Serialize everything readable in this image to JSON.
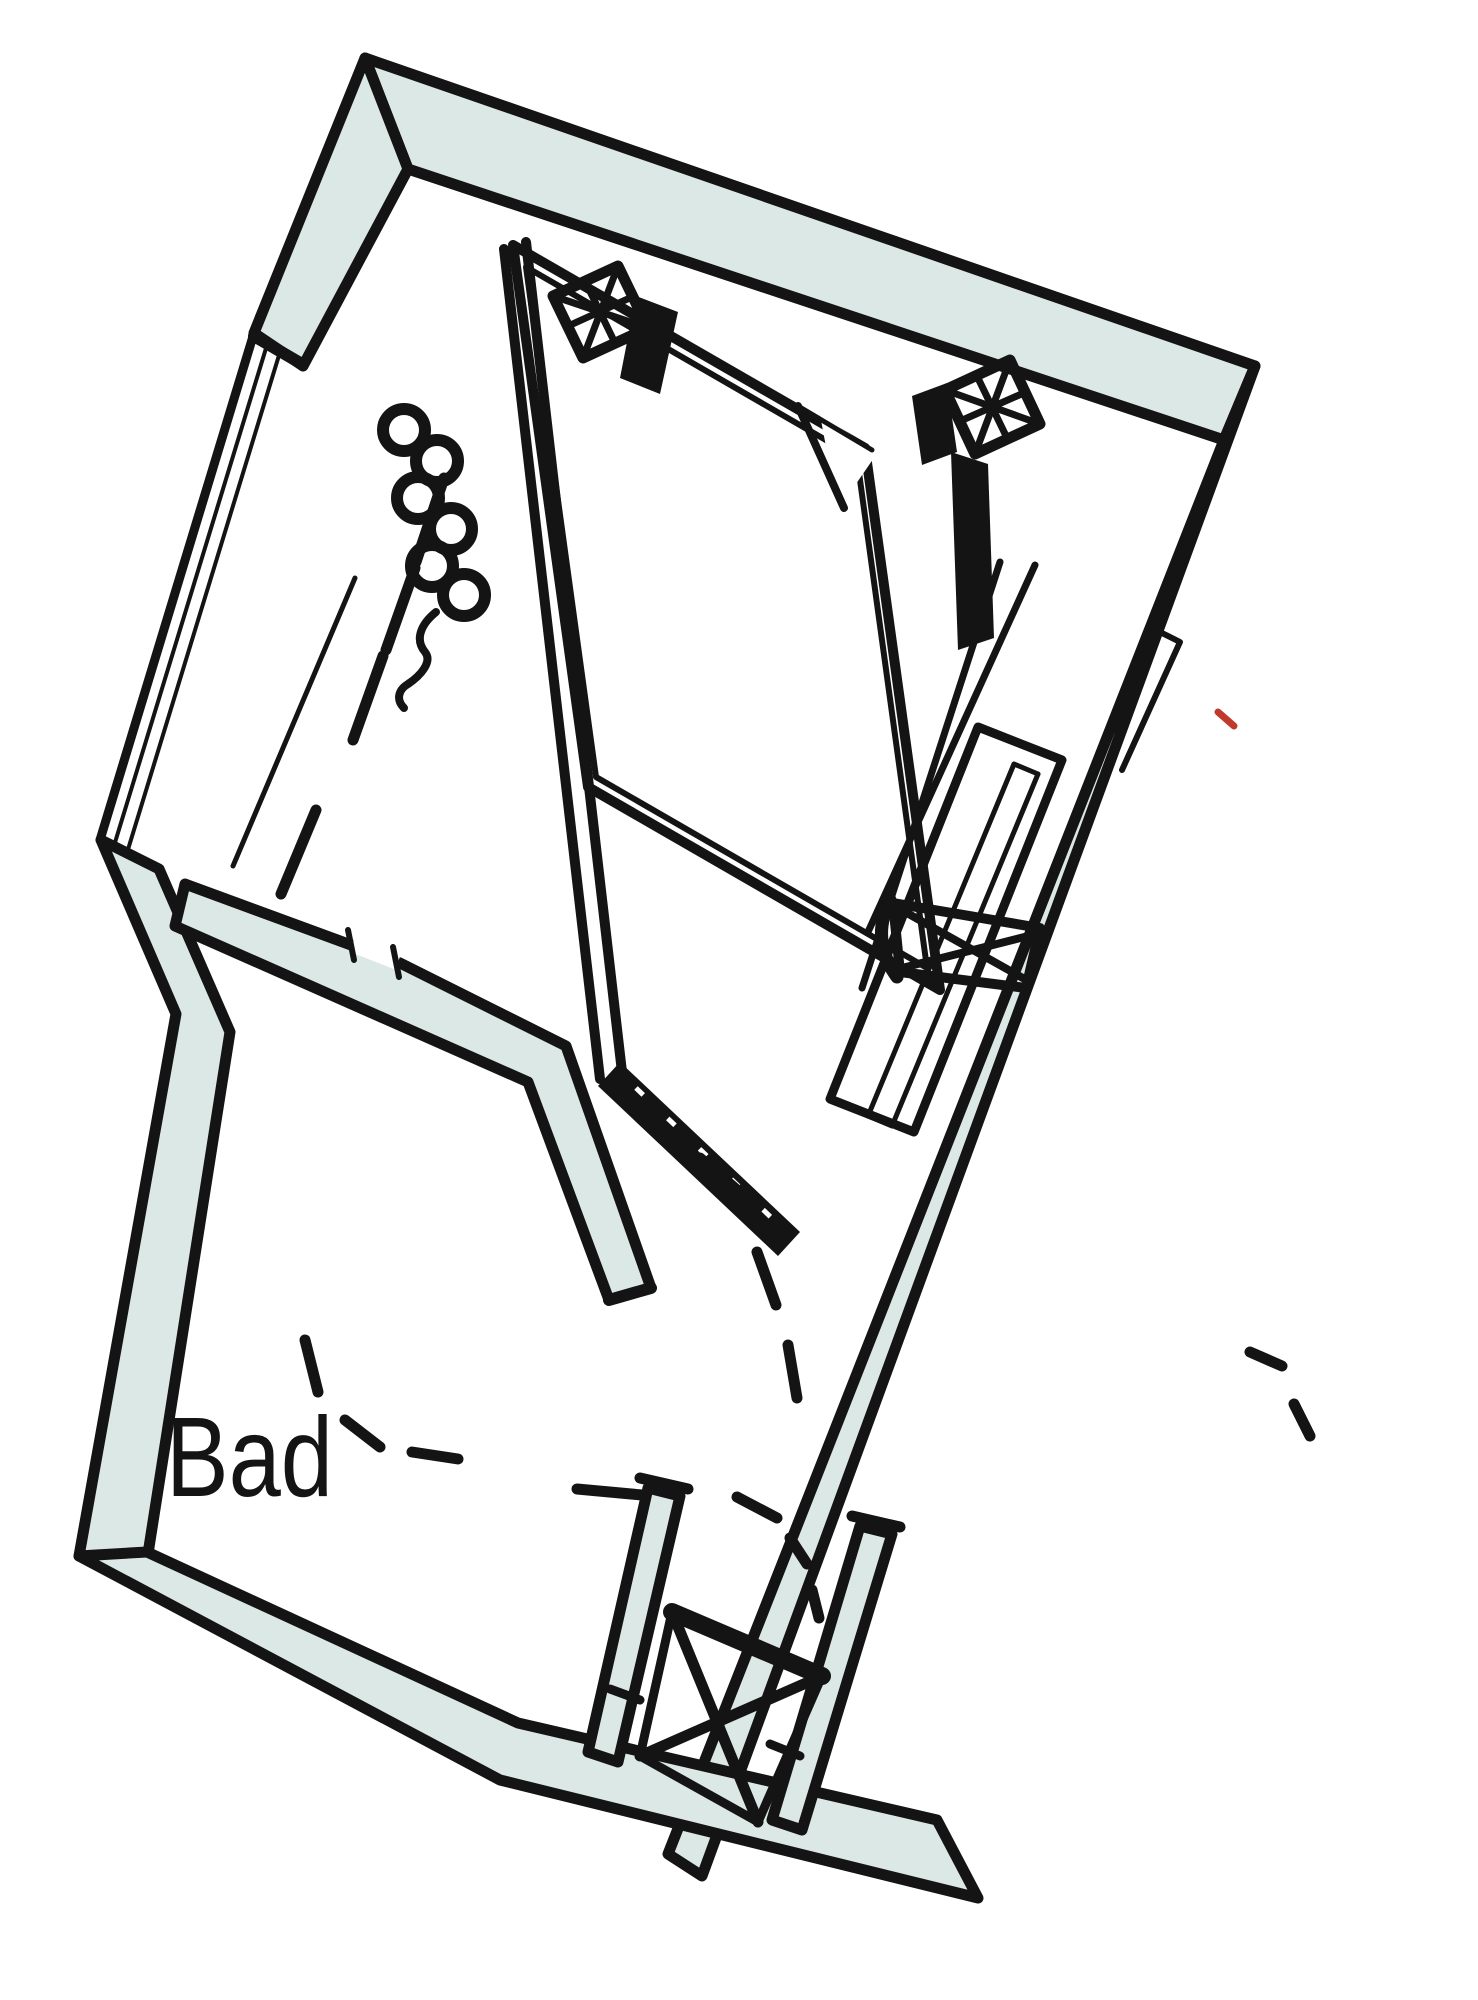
{
  "document": {
    "type": "architectural-floor-plan",
    "orientation_degrees": 24,
    "description": "Rotated floor plan detail of an apartment: bedroom with bed, radiator and ventilation symbols, desk and chair niche, hallway with door swings, duct shaft, and bathroom"
  },
  "colors": {
    "wall_fill": "#dce8e5",
    "line": "#141414",
    "background": "#ffffff",
    "accent_red": "#c03a2b"
  },
  "rooms": {
    "bathroom_label": "Bad"
  },
  "symbols": [
    "exterior-wall-band",
    "window-glazing",
    "radiator-coil",
    "ventilation-grille",
    "bed-with-folded-blanket",
    "interior-partition-wall",
    "door-leaf",
    "door-swing-dashed-arc",
    "desk",
    "office-chair",
    "duct-shaft-x-brace",
    "knee-wall-dashed-line"
  ]
}
